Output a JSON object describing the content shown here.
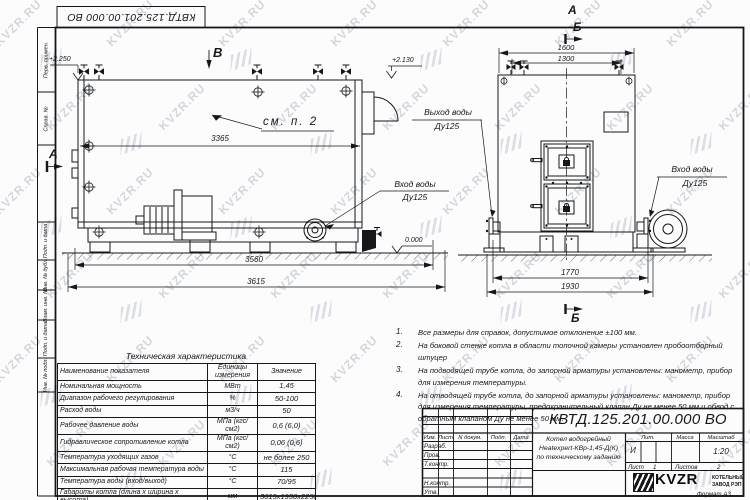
{
  "watermark": {
    "text": "KVZR.RU"
  },
  "frame": {
    "margin_labels": [
      "Перв. примен.",
      "Справ. №",
      "Подп. и дата",
      "Инв. № дубл.",
      "Взам. инв. №",
      "Подп. и дата",
      "Инв. № подл."
    ]
  },
  "side_view": {
    "view_label": "В",
    "section_a": "А",
    "see_note": "см. п. 2",
    "level_top_left": "+2.250",
    "level_top_right": "+2.130",
    "level_zero": "0.000",
    "dim_body": "3365",
    "dim_base": "3560",
    "dim_overall": "3615",
    "inlet_title": "Вход воды",
    "inlet_dn": "Ду125"
  },
  "front_view": {
    "label_a": "А",
    "label_b": "Б",
    "label_b_bottom": "Б",
    "dim_top_outer": "1600",
    "dim_top_inner": "1300",
    "dim_bottom_inner": "1770",
    "dim_bottom_outer": "1930",
    "outlet_title": "Выход воды",
    "outlet_dn": "Ду125",
    "inlet_title": "Вход воды",
    "inlet_dn": "Ду125"
  },
  "notes": [
    {
      "n": "1.",
      "t": "Все размеры для справок, допустимое отклонение ±100 мм."
    },
    {
      "n": "2.",
      "t": "На боковой стенке котла в области топочной камеры установлен пробоотборный штуцер"
    },
    {
      "n": "3.",
      "t": "На подводящей трубе котла, до запорной арматуры установлены: манометр, прибор для измерения температуры."
    },
    {
      "n": "4.",
      "t": "На отводящей трубе котла, до запорной арматуры установлены: манометр, прибор для измерения температуры, предохранительный клапан Ду не менее 50 мм и обвод с обратным клапаном Ду не менее 50 мм."
    }
  ],
  "spec": {
    "title": "Техническая характеристика",
    "headers": [
      "Наименование показателя",
      "Единицы измерения",
      "Значение"
    ],
    "rows": [
      [
        "Номинальная мощность",
        "МВт",
        "1,45"
      ],
      [
        "Диапазон рабочего регулирования",
        "%",
        "50-100"
      ],
      [
        "Расход воды",
        "м3/ч",
        "50"
      ],
      [
        "Рабочее давление воды",
        "МПа (кгс/см2)",
        "0,6 (6,0)"
      ],
      [
        "Гидравлическое сопротивление котла",
        "МПа (кгс/см2)",
        "0,06 (0,6)"
      ],
      [
        "Температура уходящих газов",
        "°С",
        "не более 250"
      ],
      [
        "Максимальная рабочая температура воды",
        "°С",
        "115"
      ],
      [
        "Температура воды (вход/выход)",
        "°С",
        "70/95"
      ],
      [
        "Габариты котла (длина х ширина х высота)",
        "мм",
        "3615х1930х2250"
      ]
    ]
  },
  "title_block": {
    "doc_number": "КВТД.125.201.00.000  ВО",
    "cols": [
      "Изм.",
      "Лист",
      "N докум.",
      "Подп.",
      "Дата"
    ],
    "rows": [
      "Разраб.",
      "Пров.",
      "Т.контр.",
      "Н.контр.",
      "Утв."
    ],
    "product": [
      "Котел водогрейный",
      "Heatexpert-КВр-1,45-Д(К)",
      "по техническому заданию"
    ],
    "lit_label": "Лит.",
    "mass_label": "Масса",
    "scale_label": "Масштаб",
    "lit": "И",
    "scale": "1:20",
    "sheet_label": "Лист",
    "sheet": "1",
    "sheets_label": "Листов",
    "sheets": "2",
    "logo": "KVZR",
    "company_line1": "КОТЕЛЬНЫЙ",
    "company_line2": "ЗАВОД РЭП",
    "format": "Формат А3"
  }
}
